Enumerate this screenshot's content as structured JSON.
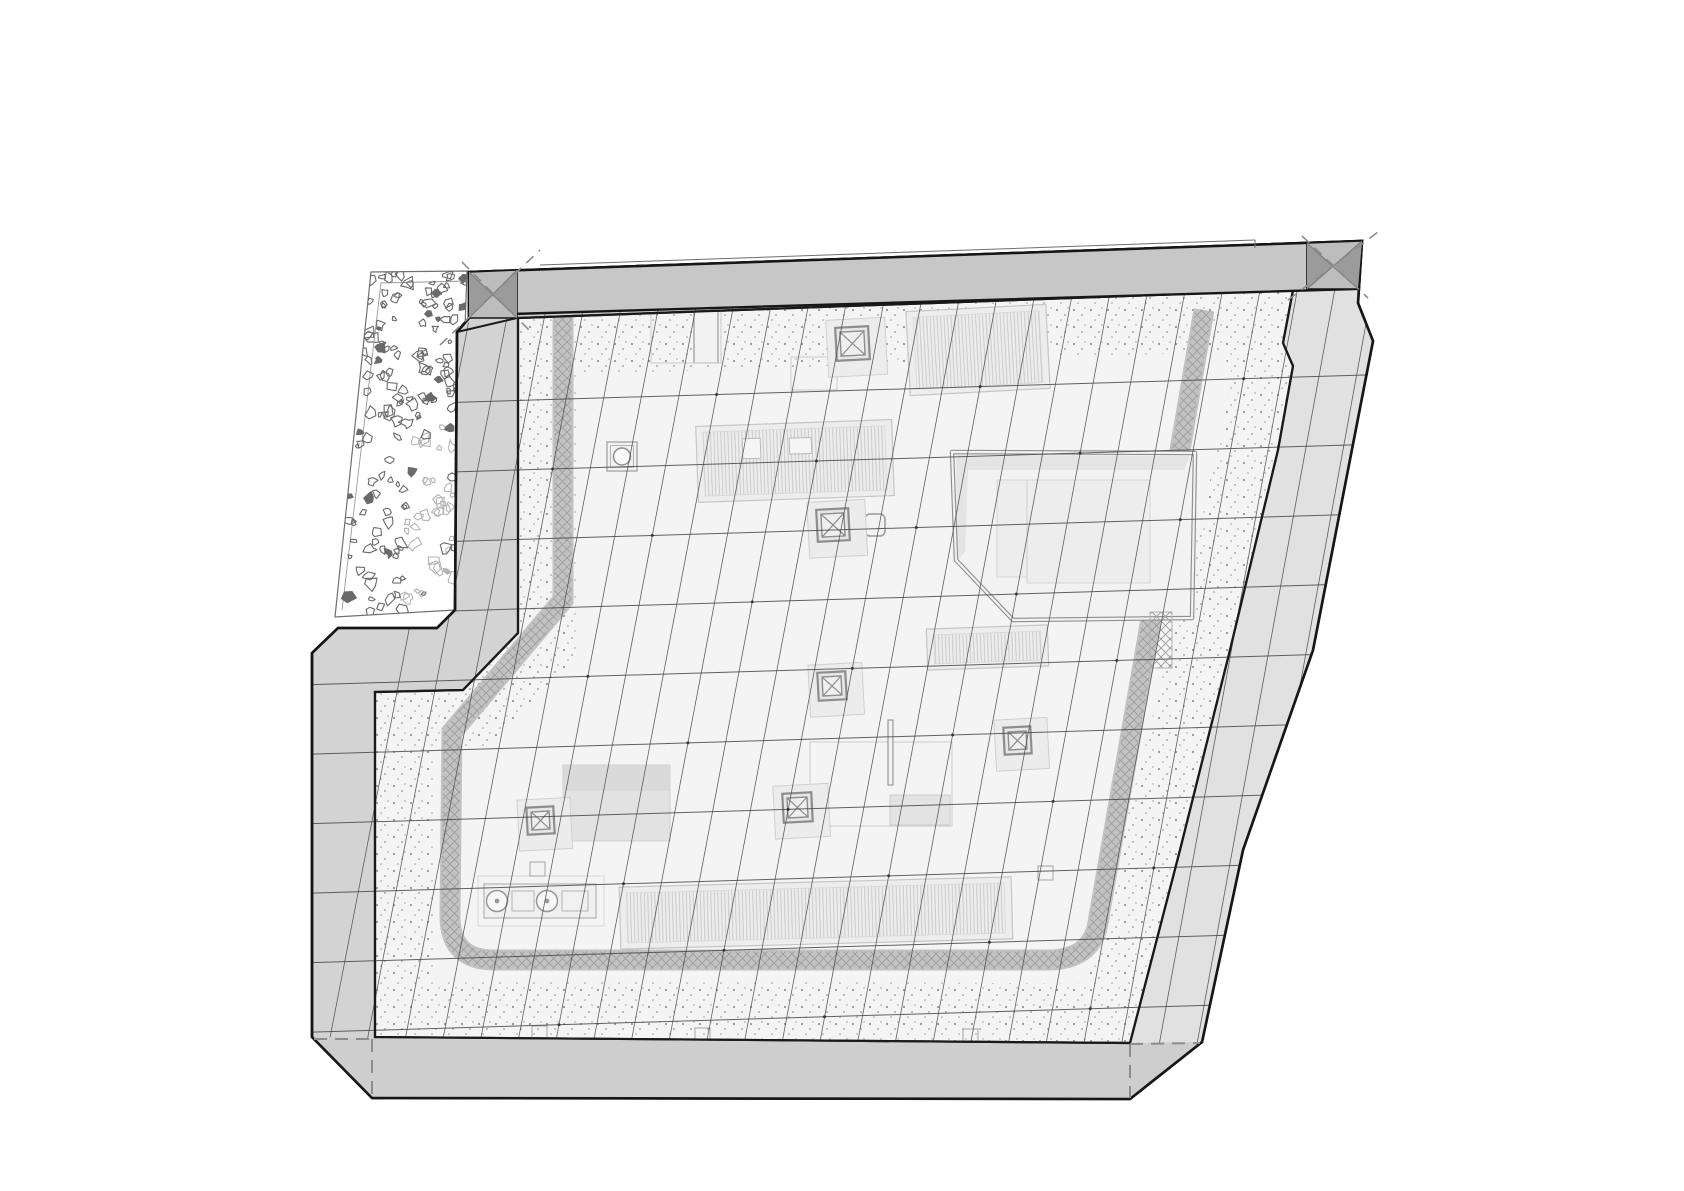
{
  "drawing": {
    "kind": "architectural-roof-plan-axonometric",
    "canvas": {
      "w": 1684,
      "h": 1191,
      "bg": "#ffffff"
    },
    "colors": {
      "outline": "#161616",
      "plate_edge": "#1a1a1a",
      "band_fill": "#c7c7c7",
      "band_corner": "#bdbdbd",
      "band_corner_dark": "#9b9b9b",
      "band_x_line": "#787878",
      "wall_fill": "#d3d3d3",
      "right_wall_fill": "#e1e1e1",
      "bottom_wall_fill": "#cecece",
      "plate_fill": "#f4f4f4",
      "grid_line": "#474747",
      "dot": "#2b2b2b",
      "object_stroke": "#c6c6c6",
      "object_fill": "#ededed",
      "hatch_frame": "#8d8d8d",
      "stipple_dot": "#909090",
      "crosshatch": "#9c9c9c",
      "walkway_edge": "#c2c2c2",
      "dashed": "#8d8d8d",
      "veg": "#6a6a6a",
      "veg_light": "#b5b5b5",
      "faint": "#cccccc",
      "shadow": "#dadada",
      "louver_line": "#c4c4c4",
      "thin_line": "#6f6f6f"
    },
    "outer_polygon": [
      [
        469,
        272
      ],
      [
        1362,
        241
      ],
      [
        1358,
        303
      ],
      [
        1373,
        341
      ],
      [
        1313,
        650
      ],
      [
        1243,
        850
      ],
      [
        1202,
        1042
      ],
      [
        1130,
        1099
      ],
      [
        372,
        1098
      ],
      [
        312,
        1037
      ],
      [
        312,
        653
      ],
      [
        338,
        628
      ],
      [
        437,
        628
      ],
      [
        455,
        610
      ],
      [
        457,
        332
      ],
      [
        469,
        318
      ]
    ],
    "plate_polygon": [
      [
        518,
        318
      ],
      [
        1293,
        290
      ],
      [
        1283,
        343
      ],
      [
        1293,
        366
      ],
      [
        1278,
        450
      ],
      [
        1230,
        650
      ],
      [
        1180,
        850
      ],
      [
        1130,
        1043
      ],
      [
        375,
        1037
      ],
      [
        375,
        692
      ],
      [
        463,
        690
      ],
      [
        518,
        633
      ]
    ],
    "grid_region": [
      [
        478,
        315
      ],
      [
        1357,
        289
      ],
      [
        1358,
        303
      ],
      [
        1373,
        341
      ],
      [
        1313,
        650
      ],
      [
        1243,
        850
      ],
      [
        1202,
        1042
      ],
      [
        1130,
        1043
      ],
      [
        375,
        1038
      ],
      [
        312,
        1037
      ],
      [
        312,
        653
      ],
      [
        338,
        628
      ],
      [
        437,
        628
      ],
      [
        455,
        610
      ],
      [
        457,
        332
      ]
    ],
    "right_band_polygon": [
      [
        1357,
        289
      ],
      [
        1358,
        303
      ],
      [
        1373,
        341
      ],
      [
        1313,
        650
      ],
      [
        1243,
        850
      ],
      [
        1202,
        1042
      ],
      [
        1130,
        1043
      ],
      [
        1180,
        850
      ],
      [
        1230,
        650
      ],
      [
        1278,
        450
      ],
      [
        1293,
        366
      ],
      [
        1283,
        343
      ],
      [
        1293,
        290
      ]
    ],
    "bottom_band_polygon": [
      [
        312,
        1037
      ],
      [
        375,
        1038
      ],
      [
        1130,
        1043
      ],
      [
        1202,
        1042
      ],
      [
        1130,
        1099
      ],
      [
        372,
        1098
      ]
    ],
    "top_band": {
      "polygon": [
        [
          469,
          272
        ],
        [
          1362,
          241
        ],
        [
          1357,
          289
        ],
        [
          478,
          315
        ]
      ],
      "thin_line": [
        [
          540,
          265
        ],
        [
          1255,
          240
        ]
      ],
      "thin_line_tick": [
        [
          1255,
          240
        ],
        [
          1255,
          248
        ]
      ],
      "chamfer_segment": [
        [
          457,
          332
        ],
        [
          517,
          318
        ]
      ],
      "corner_squares": [
        {
          "name": "corner-x-top-left",
          "quad": [
            [
              469,
              272
            ],
            [
              517,
              270
            ],
            [
              517,
              318
            ],
            [
              469,
              318
            ]
          ],
          "tri_a": [
            [
              469,
              272
            ],
            [
              493,
              295
            ],
            [
              469,
              318
            ]
          ],
          "tri_b": [
            [
              517,
              270
            ],
            [
              517,
              318
            ],
            [
              493,
              295
            ]
          ]
        },
        {
          "name": "corner-x-top-right",
          "quad": [
            [
              1307,
              243
            ],
            [
              1362,
              241
            ],
            [
              1358,
              289
            ],
            [
              1307,
              289
            ]
          ],
          "tri_a": [
            [
              1307,
              243
            ],
            [
              1334,
              266
            ],
            [
              1307,
              289
            ]
          ],
          "tri_b": [
            [
              1362,
              241
            ],
            [
              1358,
              289
            ],
            [
              1334,
              266
            ]
          ]
        }
      ]
    },
    "dashes": {
      "corner_diagonals": [
        [
          [
            440,
            345
          ],
          [
            540,
            250
          ]
        ],
        [
          [
            462,
            262
          ],
          [
            530,
            331
          ]
        ],
        [
          [
            1288,
            300
          ],
          [
            1378,
            232
          ]
        ],
        [
          [
            1302,
            236
          ],
          [
            1368,
            298
          ]
        ]
      ],
      "bottom_hidden_edges": [
        [
          [
            314,
            1039
          ],
          [
            371,
            1039
          ]
        ],
        [
          [
            372,
            1039
          ],
          [
            372,
            1097
          ]
        ],
        [
          [
            1130,
            1044
          ],
          [
            1200,
            1043
          ]
        ],
        [
          [
            1130,
            1044
          ],
          [
            1130,
            1098
          ]
        ]
      ]
    },
    "veg_strip": {
      "polygon": [
        [
          371,
          272
        ],
        [
          467,
          271
        ],
        [
          455,
          610
        ],
        [
          335,
          617
        ]
      ],
      "inner_left_line": [
        [
          381,
          283
        ],
        [
          342,
          610
        ]
      ],
      "inner_top_line": [
        [
          381,
          283
        ],
        [
          466,
          281
        ]
      ],
      "blob_count": 185,
      "seed": 12
    },
    "stipple_band_width": 118,
    "walkway": {
      "path": "M563,316 L563,600 L452,732 L450,916 Q450,960 494,960 L1048,960 Q1088,960 1097,928 L1146,648 L1204,310",
      "width": 17,
      "edge_width": 21
    },
    "grid": {
      "steep": {
        "count": 25,
        "x_top0": 470,
        "dx_top": 37.6,
        "x_bot0": 330,
        "dx_bot": 37.7,
        "top_ref_x": 478,
        "top_ref_y": 315,
        "top_slope": -0.0296,
        "bot_ref_x": 375,
        "bot_ref_y": 1038,
        "bot_slope": 0.0066
      },
      "horizontal": {
        "count": 10,
        "x_ref": 600,
        "y0": 398,
        "dy": 69.5,
        "slope": -0.03,
        "x_min": 300,
        "x_max": 1390
      },
      "line_width_steep": 0.8,
      "line_width_horizontal": 1.0,
      "dot_radius": 1.5
    },
    "objects": [
      {
        "id": "sunken-courtyard",
        "type": "courtyard",
        "polygon": [
          [
            952,
            452
          ],
          [
            1195,
            453
          ],
          [
            1192,
            618
          ],
          [
            1013,
            620
          ],
          [
            956,
            560
          ]
        ],
        "shadow_quads": [
          [
            [
              956,
              455
            ],
            [
              1190,
              456
            ],
            [
              1184,
              470
            ],
            [
              968,
              470
            ]
          ],
          [
            [
              956,
              455
            ],
            [
              968,
              470
            ],
            [
              965,
              552
            ],
            [
              958,
              560
            ]
          ]
        ],
        "inner_rects": [
          [
            997,
            480,
            30,
            97
          ],
          [
            1027,
            480,
            123,
            103
          ]
        ],
        "hatch_square": [
          1150,
          612,
          22,
          56
        ]
      },
      {
        "id": "skylight-louver-top",
        "type": "louver",
        "x": 908,
        "y": 308,
        "w": 140,
        "h": 84,
        "angle": -3
      },
      {
        "id": "skylight-louver-left",
        "type": "louver",
        "x": 697,
        "y": 423,
        "w": 196,
        "h": 76,
        "angle": -2,
        "subrects": [
          [
            743,
            437,
            18,
            20
          ],
          [
            790,
            438,
            22,
            16
          ]
        ]
      },
      {
        "id": "skylight-louver-right",
        "type": "louver",
        "x": 927,
        "y": 627,
        "w": 121,
        "h": 41,
        "angle": -2
      },
      {
        "id": "skylight-louver-bottom",
        "type": "louver",
        "x": 620,
        "y": 882,
        "w": 392,
        "h": 62,
        "angle": -1.5
      },
      {
        "id": "vent-stack",
        "type": "plain_rect",
        "x": 694,
        "y": 305,
        "w": 24,
        "h": 58
      },
      {
        "id": "frame-top",
        "type": "frame",
        "x": 651,
        "y": 298,
        "w": 70,
        "h": 65
      },
      {
        "id": "frame-below-hatch",
        "type": "frame",
        "x": 791,
        "y": 357,
        "w": 46,
        "h": 33
      },
      {
        "id": "equipment-frame",
        "type": "frame",
        "x": 810,
        "y": 742,
        "w": 142,
        "h": 84,
        "fill_rect": [
          890,
          795,
          60,
          30
        ]
      },
      {
        "id": "antenna-rect",
        "type": "plain_rect",
        "x": 888,
        "y": 720,
        "w": 5,
        "h": 65
      },
      {
        "id": "gray-block",
        "type": "block",
        "x": 563,
        "y": 765,
        "w": 107,
        "h": 76
      },
      {
        "id": "mech-unit",
        "type": "mech_unit",
        "x": 484,
        "y": 884,
        "w": 112,
        "h": 34
      },
      {
        "id": "vent-circle",
        "type": "circle_vent",
        "x": 607,
        "y": 442,
        "w": 30,
        "h": 29
      },
      {
        "id": "vent-rounded",
        "type": "rounded_square",
        "x": 865,
        "y": 514,
        "w": 20,
        "h": 22
      },
      {
        "id": "roof-hatch-top",
        "type": "roof_hatch",
        "x": 836,
        "y": 327,
        "s": 33,
        "angle": -3
      },
      {
        "id": "roof-hatch-upper",
        "type": "roof_hatch",
        "x": 817,
        "y": 509,
        "s": 32,
        "angle": -3
      },
      {
        "id": "roof-hatch-center",
        "type": "roof_hatch",
        "x": 818,
        "y": 672,
        "s": 28,
        "angle": -3
      },
      {
        "id": "roof-hatch-right",
        "type": "roof_hatch",
        "x": 1004,
        "y": 727,
        "s": 27,
        "angle": -3
      },
      {
        "id": "roof-hatch-lower",
        "type": "roof_hatch",
        "x": 783,
        "y": 793,
        "s": 29,
        "angle": -3
      },
      {
        "id": "roof-hatch-left",
        "type": "roof_hatch",
        "x": 527,
        "y": 807,
        "s": 27,
        "angle": -3
      },
      {
        "id": "tiny-square-1",
        "type": "tiny_square",
        "x": 532,
        "y": 1026,
        "w": 15,
        "h": 13
      },
      {
        "id": "tiny-square-2",
        "type": "tiny_square",
        "x": 695,
        "y": 1028,
        "w": 15,
        "h": 13
      },
      {
        "id": "tiny-square-3",
        "type": "tiny_square",
        "x": 963,
        "y": 1029,
        "w": 15,
        "h": 13
      },
      {
        "id": "tiny-square-4",
        "type": "tiny_square",
        "x": 530,
        "y": 862,
        "w": 15,
        "h": 14
      },
      {
        "id": "tiny-square-5",
        "type": "tiny_square",
        "x": 1038,
        "y": 866,
        "w": 15,
        "h": 14
      }
    ]
  }
}
